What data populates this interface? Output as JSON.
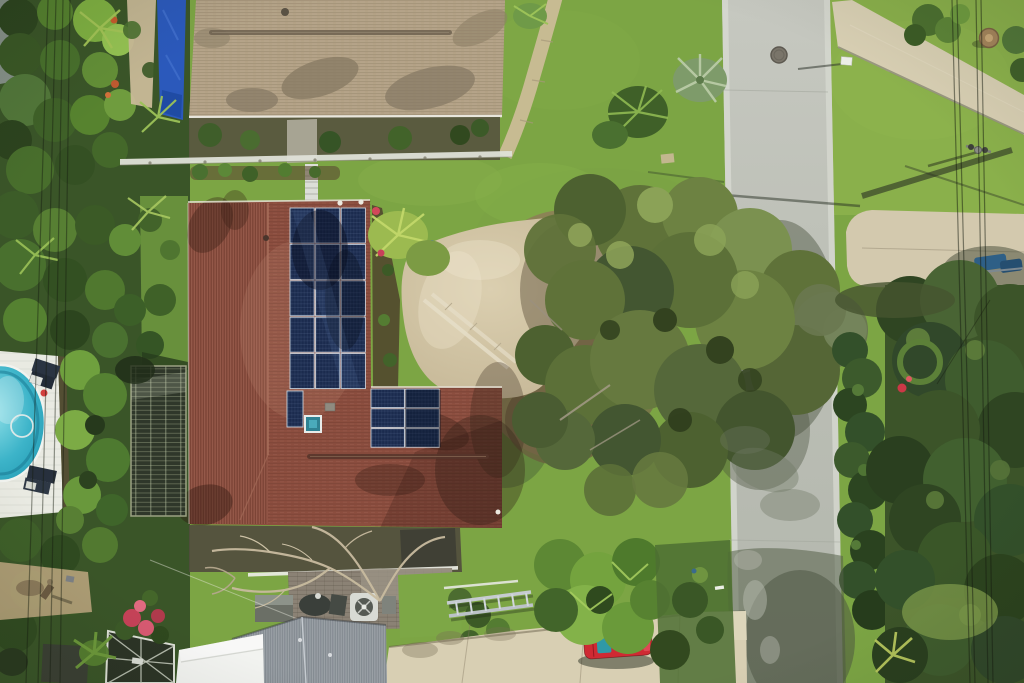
{
  "scene": {
    "type": "aerial-drone-photograph",
    "description": "Overhead aerial view of a suburban Florida home with rooftop solar panels, a screened enclosure and swimming pool on the left, a neighboring tan-roofed house with a blue tarp at top, a vertical gray residential street on the right with driveways, a large oak tree at center, dense tropical vegetation, and a red car parked on the bottom driveway.",
    "objects": [
      {
        "name": "main-house-roof",
        "color": "reddish-brown shingle"
      },
      {
        "name": "solar-panel-arrays",
        "count": 3,
        "color": "dark blue"
      },
      {
        "name": "skylight",
        "color": "teal"
      },
      {
        "name": "neighbor-house-roof",
        "color": "tan shingle"
      },
      {
        "name": "blue-tarp",
        "color": "blue"
      },
      {
        "name": "swimming-pool",
        "color": "turquoise"
      },
      {
        "name": "pool-deck",
        "color": "white"
      },
      {
        "name": "screened-enclosure",
        "color": "dark olive grid"
      },
      {
        "name": "street",
        "orientation": "vertical",
        "color": "gray asphalt"
      },
      {
        "name": "manhole-cover"
      },
      {
        "name": "streetlight-head"
      },
      {
        "name": "upper-driveway"
      },
      {
        "name": "lower-driveway"
      },
      {
        "name": "bottom-driveway",
        "color": "beige concrete"
      },
      {
        "name": "red-car",
        "color": "red with teal seats"
      },
      {
        "name": "oak-tree-canopy",
        "color": "olive green"
      },
      {
        "name": "roadside-hedge"
      },
      {
        "name": "utility-pole"
      },
      {
        "name": "power-lines"
      },
      {
        "name": "bare-tree"
      },
      {
        "name": "air-conditioner-unit"
      },
      {
        "name": "gray-shingle-roof"
      },
      {
        "name": "white-metal-roof"
      },
      {
        "name": "pool-cage-screen"
      },
      {
        "name": "pink-flower-bush"
      },
      {
        "name": "palm-trees"
      }
    ]
  },
  "palette": {
    "grass": "#7ca544",
    "grass_light": "#8ab04b",
    "road": "#bcbfb6",
    "curb": "#d6d8d0",
    "roof_main": "#8c4e3f",
    "roof_neighbor": "#b3a286",
    "solar_panel": "#1b2b4e",
    "solar_frame": "#c8d2dc",
    "tarp": "#2b59bb",
    "pool_water": "#3db4c9",
    "pool_deck": "#e9eae2",
    "driveway": "#d8cfb3",
    "sand": "#cdbf9f",
    "hedge": "#33502a",
    "forest": "#3c5429",
    "jungle": "#3a5528",
    "enclosure": "#2f372a",
    "enclosure_grid": "#9ba283",
    "gray_roof": "#90979d",
    "white_roof": "#f2f3f0",
    "screen_cage": "#2c3426",
    "car_red": "#cf2a33",
    "car_teal": "#2f99a6",
    "flowers": "#c64258",
    "litter": "#8d7c58",
    "tree_canopy": "#65793e",
    "shadow": "#4a523f"
  },
  "solar_arrays": [
    {
      "name": "main-array",
      "x": 290,
      "y": 208,
      "cols": 3,
      "rows": 5,
      "panel_w": 24.2,
      "panel_h": 35,
      "gap": 1.4
    },
    {
      "name": "single-panel",
      "x": 287,
      "y": 391,
      "cols": 1,
      "rows": 1,
      "panel_w": 16,
      "panel_h": 36,
      "gap": 0
    },
    {
      "name": "east-array",
      "x": 371,
      "y": 389,
      "cols": 2,
      "rows": 3,
      "panel_w": 33.5,
      "panel_h": 18.6,
      "gap": 1.2
    }
  ],
  "power_lines": {
    "left": [
      [
        48,
        0,
        26,
        683
      ],
      [
        56,
        0,
        38,
        683
      ],
      [
        63,
        0,
        50,
        683
      ],
      [
        70,
        0,
        60,
        683
      ]
    ],
    "right": [
      [
        952,
        0,
        970,
        683
      ],
      [
        957,
        0,
        975,
        683
      ],
      [
        976,
        0,
        988,
        683
      ],
      [
        981,
        0,
        993,
        683
      ]
    ],
    "service": [
      [
        990,
        300,
        937,
        384
      ]
    ]
  }
}
